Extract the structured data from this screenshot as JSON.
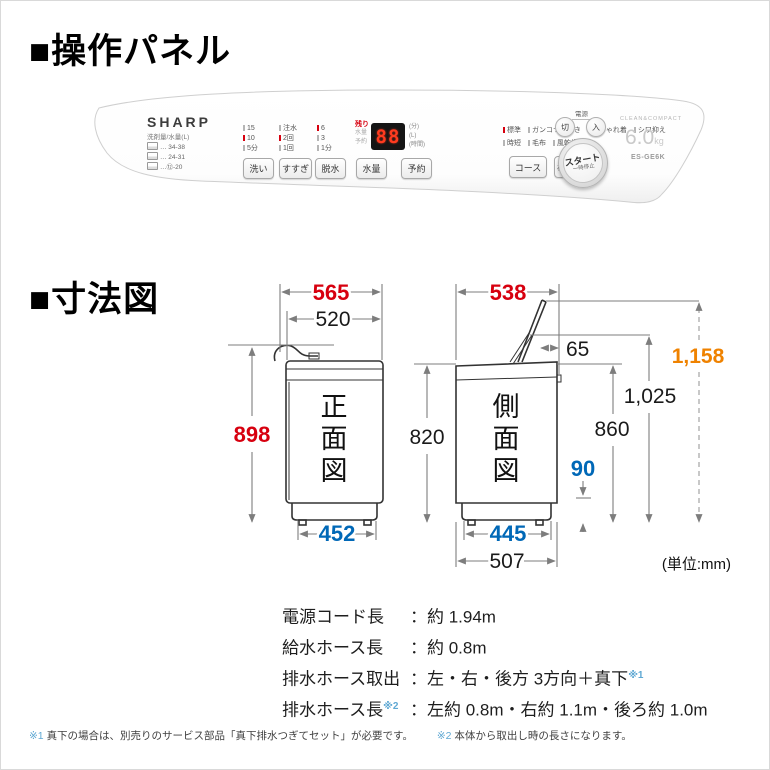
{
  "sections": {
    "panel_title": "■操作パネル",
    "dim_title": "■寸法図"
  },
  "panel": {
    "brand": "SHARP",
    "legend": {
      "title": "洗剤量/水量(L)",
      "rows": [
        "… 34-38",
        "… 24-31",
        "…⑫-20"
      ]
    },
    "selectors": [
      {
        "button": "洗い",
        "options": [
          "15",
          "10",
          "5分"
        ]
      },
      {
        "button": "すすぎ",
        "options": [
          "注水",
          "2回",
          "1回"
        ]
      },
      {
        "button": "脱水",
        "options": [
          "6",
          "3",
          "1分"
        ]
      }
    ],
    "display": {
      "remaining_label": "残り",
      "sub_labels": [
        "水量",
        "予約"
      ],
      "value": "88",
      "unit_labels": [
        "(分)",
        "(L)",
        "(時間)"
      ]
    },
    "buttons": {
      "water_level": "水量",
      "reserve": "予約",
      "course": "コース",
      "tub_clean": "槽クリーン"
    },
    "courses": {
      "row1": [
        "標準",
        "ガンコつけおき",
        "おしゃれ着",
        "シワ抑え"
      ],
      "row2": [
        "時短",
        "毛布",
        "風乾燥"
      ]
    },
    "power": {
      "label": "電源",
      "off": "切",
      "on": "入"
    },
    "start": {
      "line1": "スタート",
      "line2": "一時停止"
    },
    "capacity": {
      "tagline": "CLEAN&COMPACT",
      "value": "6.0",
      "unit": "kg",
      "model": "ES-GE6K"
    }
  },
  "diagram": {
    "front": {
      "chars": [
        "正",
        "面",
        "図"
      ],
      "width_total": "565",
      "width_body": "520",
      "height": "898",
      "feet_span": "452"
    },
    "side": {
      "chars": [
        "側",
        "面",
        "図"
      ],
      "depth_total": "538",
      "lid_offset": "65",
      "height_body": "820",
      "height_back": "860",
      "height_1025": "1,025",
      "height_lid_open": "1,158",
      "drain_height": "90",
      "feet_span": "445",
      "depth_body": "507"
    },
    "unit_note": "(単位:mm)"
  },
  "specs": {
    "rows": [
      {
        "label": "電源コード長",
        "label_sup": "",
        "value": "：約 1.94m",
        "value_sup": ""
      },
      {
        "label": "給水ホース長",
        "label_sup": "",
        "value": "：約 0.8m",
        "value_sup": ""
      },
      {
        "label": "排水ホース取出",
        "label_sup": "",
        "value": "：左・右・後方 3方向＋真下",
        "value_sup": "※1"
      },
      {
        "label": "排水ホース長",
        "label_sup": "※2",
        "value": "：左約 0.8m・右約 1.1m・後ろ約 1.0m",
        "value_sup": ""
      }
    ]
  },
  "footnotes": [
    {
      "mark": "※1",
      "text": "真下の場合は、別売りのサービス部品「真下排水つぎてセット」が必要です。"
    },
    {
      "mark": "※2",
      "text": "本体から取出し時の長さになります。"
    }
  ],
  "colors": {
    "dim_red": "#d7000f",
    "dim_blue": "#0068b7",
    "dim_orange": "#ef8200",
    "footnote_blue": "#5fa8d3",
    "segment_red": "#ff3b1f"
  }
}
